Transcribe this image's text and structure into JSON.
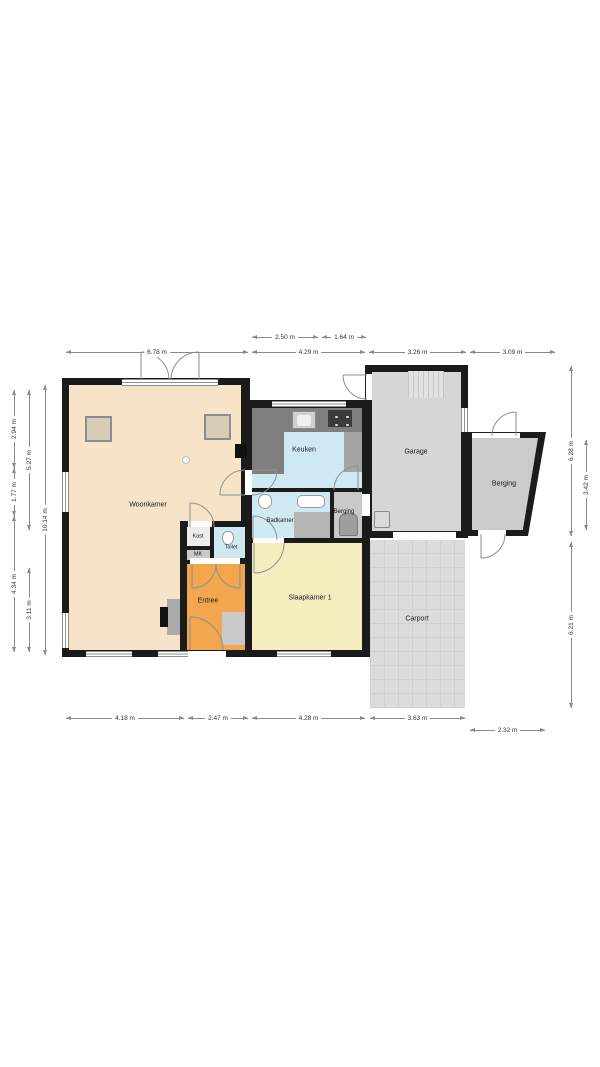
{
  "floorplan": {
    "rooms": [
      {
        "id": "woonkamer",
        "label": "Woonkamer"
      },
      {
        "id": "keuken",
        "label": "Keuken"
      },
      {
        "id": "badkamer",
        "label": "Badkamer"
      },
      {
        "id": "berging-mid",
        "label": "Berging"
      },
      {
        "id": "kast",
        "label": "Kast"
      },
      {
        "id": "mk",
        "label": "MK"
      },
      {
        "id": "toilet",
        "label": "Toilet"
      },
      {
        "id": "entree",
        "label": "Entree"
      },
      {
        "id": "slaapkamer-1",
        "label": "Slaapkamer 1"
      },
      {
        "id": "garage",
        "label": "Garage"
      },
      {
        "id": "berging-right",
        "label": "Berging"
      },
      {
        "id": "carport",
        "label": "Carport"
      }
    ],
    "dimensions": {
      "top_inner": [
        "2.50 m",
        "1.64 m"
      ],
      "top": [
        "6.78 m",
        "4.29 m",
        "3.26 m",
        "3.09 m"
      ],
      "left_a": [
        "2.94 m",
        "1.77 m",
        "4.34 m"
      ],
      "left_b": [
        "5.27 m",
        "3.11 m"
      ],
      "left_total": "10.14 m",
      "right_a": [
        "6.28 m",
        "6.21 m"
      ],
      "right_b": "3.42 m",
      "bottom": [
        "4.18 m",
        "2.47 m",
        "4.28 m",
        "3.63 m"
      ],
      "bottom_right": "2.32 m"
    },
    "colors": {
      "wall": "#1b1b1b",
      "woonkamer": "#f6e3c8",
      "entree": "#f2a64d",
      "wet_rooms": "#cfe9f3",
      "slaapkamer": "#f4eebf",
      "garage": "#d6d6d6",
      "berging": "#c9c9c9",
      "carport": "#dcdcdc",
      "counter": "#7f7f7f"
    }
  }
}
